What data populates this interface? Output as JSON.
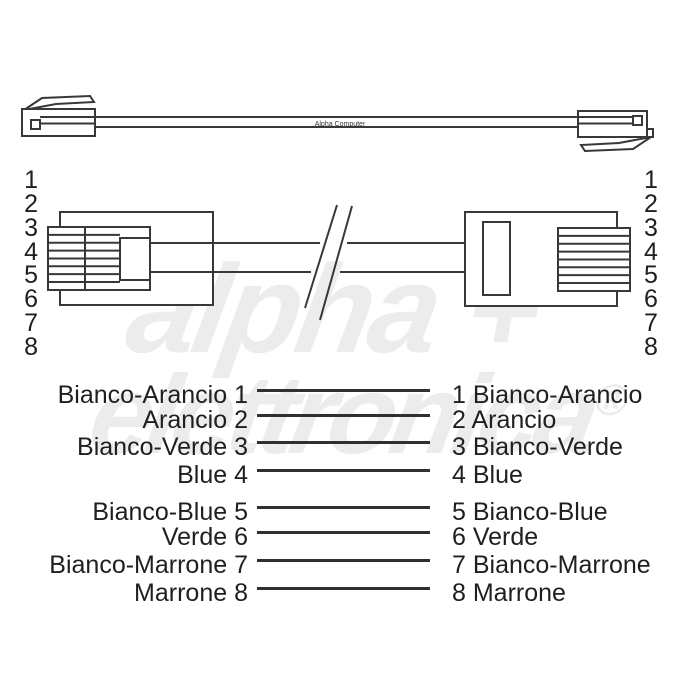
{
  "cable": {
    "label": "Alpha Computer"
  },
  "pins": {
    "left": [
      "1",
      "2",
      "3",
      "4",
      "5",
      "6",
      "7",
      "8"
    ],
    "right": [
      "1",
      "2",
      "3",
      "4",
      "5",
      "6",
      "7",
      "8"
    ]
  },
  "wiring": {
    "rows": [
      {
        "left": "Bianco-Arancio 1",
        "right": "1 Bianco-Arancio"
      },
      {
        "left": "Arancio 2",
        "right": "2 Arancio"
      },
      {
        "left": "Bianco-Verde 3",
        "right": "3 Bianco-Verde"
      },
      {
        "left": "Blue 4",
        "right": "4 Blue"
      },
      {
        "left": "Bianco-Blue 5",
        "right": "5 Bianco-Blue"
      },
      {
        "left": "Verde 6",
        "right": "6 Verde"
      },
      {
        "left": "Bianco-Marrone 7",
        "right": "7 Bianco-Marrone"
      },
      {
        "left": "Marrone 8",
        "right": "8 Marrone"
      }
    ]
  },
  "watermark": {
    "word1": "alpha",
    "plus": "+",
    "word2": "elettronica",
    "registered": "®"
  },
  "colors": {
    "background": "#ffffff",
    "diagram_stroke": "#383838",
    "list_line": "#2f2f2f",
    "text": "#1f1f1f",
    "cable_label_text": "#333333",
    "watermark": "#ececec"
  }
}
